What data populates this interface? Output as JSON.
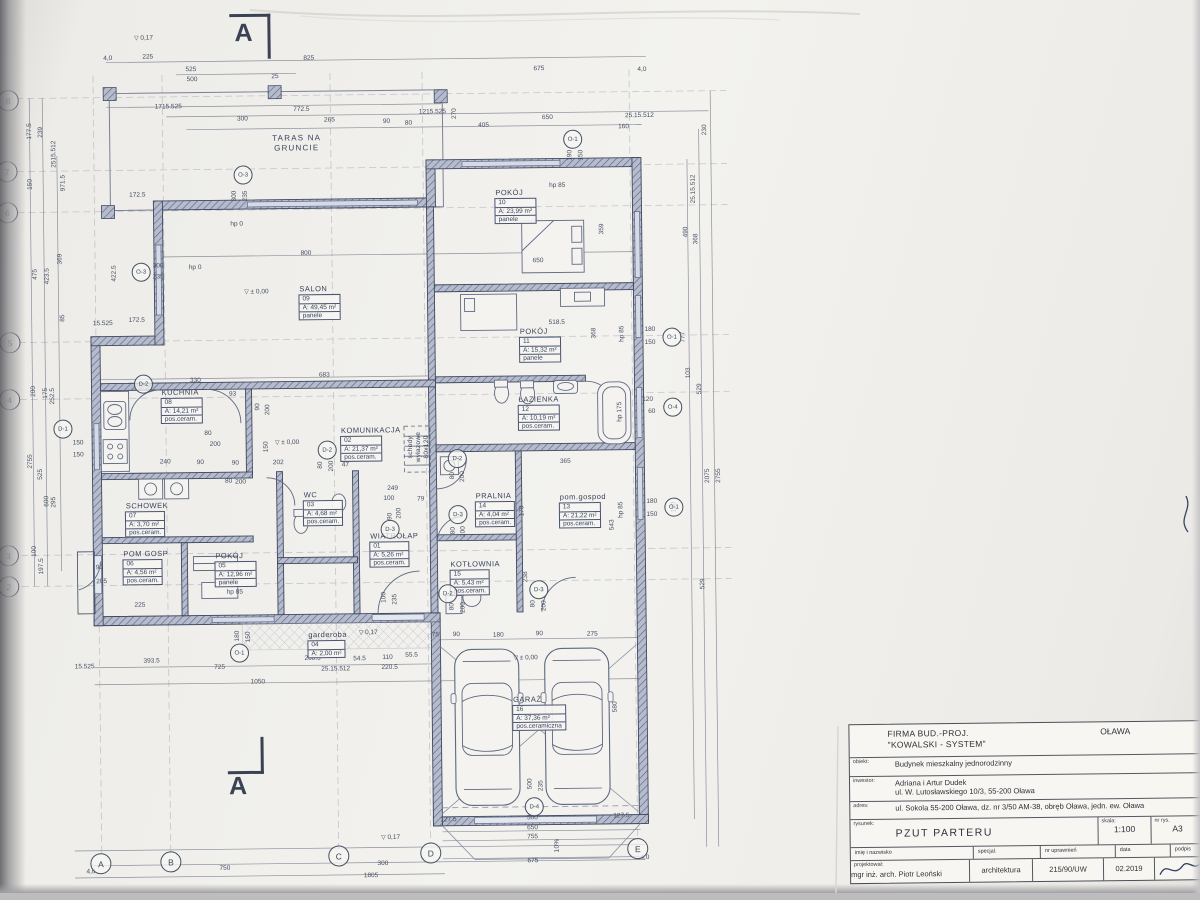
{
  "section": {
    "label": "A"
  },
  "colors": {
    "ink": "#3d4659",
    "wall": "#3e4860",
    "paper": "#f3f2ee",
    "accent": "#5d6880"
  },
  "titleblock": {
    "company1": "FIRMA BUD.-PROJ.",
    "company2": "\"KOWALSKI - SYSTEM\"",
    "city": "OŁAWA",
    "city_addr": "ul.Brzeska 19",
    "obiekt_label": "obiekt:",
    "obiekt": "Budynek mieszkalny jednorodzinny",
    "inwestor_label": "inwestor:",
    "inwestor1": "Adriana i Artur Dudek",
    "inwestor2": "ul. W. Lutosławskiego 10/3, 55-200 Oława",
    "adres_label": "adres:",
    "adres": "ul. Sokola 55-200 Oława, dz. nr 3/50 AM-38, obręb Oława, jedn. ew. Oława",
    "rysunek_label": "rysunek:",
    "rysunek": "PZUT PARTERU",
    "skala_label": "skala:",
    "skala": "1:100",
    "nr_label": "nr rys.",
    "nr": "A3",
    "h_name": "imię i nazwisko",
    "h_spec": "specjal.",
    "h_lic": "nr uprawnień",
    "h_date": "data",
    "h_sign": "podpis",
    "proj_label": "projektował:",
    "proj_name": "mgr inż. arch. Piotr Leoński",
    "proj_spec": "architektura",
    "proj_lic": "215/90/UW",
    "proj_date": "02.2019"
  },
  "plan": {
    "rooms": [
      {
        "id": "wiatrolap",
        "name": "WIATROŁAP",
        "num": "01",
        "area": "A: 5,26 m²",
        "fin": "pos.ceram.",
        "x": 368,
        "y": 530
      },
      {
        "id": "komunikacja",
        "name": "KOMUNIKACJA",
        "num": "02",
        "area": "A: 21,37 m²",
        "fin": "pos.ceram.",
        "x": 340,
        "y": 424
      },
      {
        "id": "wc",
        "name": "WC",
        "num": "03",
        "area": "A: 4,68 m²",
        "fin": "pos.ceram.",
        "x": 302,
        "y": 488
      },
      {
        "id": "garderoba",
        "name": "garderoba",
        "num": "04",
        "area": "A: 2,00 m²",
        "fin": "",
        "x": 305,
        "y": 628
      },
      {
        "id": "pokoj-05",
        "name": "POKÓJ",
        "num": "05",
        "area": "A: 12,96 m²",
        "fin": "panele",
        "x": 213,
        "y": 548
      },
      {
        "id": "pom-gosp",
        "name": "POM GOSP",
        "num": "06",
        "area": "A: 4,56 m²",
        "fin": "pos.ceram.",
        "x": 121,
        "y": 545
      },
      {
        "id": "schowek",
        "name": "SCHOWEK",
        "num": "07",
        "area": "A: 3,70 m²",
        "fin": "pos.ceram.",
        "x": 124,
        "y": 497
      },
      {
        "id": "kuchnia",
        "name": "KUCHNIA",
        "num": "08",
        "area": "A: 14,21 m²",
        "fin": "pos.ceram.",
        "x": 161,
        "y": 384
      },
      {
        "id": "salon",
        "name": "SALON",
        "num": "09",
        "area": "A: 49,45 m²",
        "fin": "panele",
        "x": 300,
        "y": 282
      },
      {
        "id": "pokoj-10",
        "name": "POKÓJ",
        "num": "10",
        "area": "A: 23,99 m²",
        "fin": "panele",
        "x": 497,
        "y": 188
      },
      {
        "id": "pokoj-11",
        "name": "POKÓJ",
        "num": "11",
        "area": "A: 15,32 m²",
        "fin": "panele",
        "x": 520,
        "y": 327
      },
      {
        "id": "lazienka",
        "name": "ŁAZIENKA",
        "num": "12",
        "area": "A: 10,19 m²",
        "fin": "pos.ceram.",
        "x": 518,
        "y": 395
      },
      {
        "id": "pom-gospod",
        "name": "pom.gospod",
        "num": "13",
        "area": "A: 21,22 m²",
        "fin": "pos.ceram.",
        "x": 558,
        "y": 493
      },
      {
        "id": "pralnia",
        "name": "PRALNIA",
        "num": "14",
        "area": "A: 4,04 m²",
        "fin": "pos.ceram.",
        "x": 474,
        "y": 491
      },
      {
        "id": "kotlownia",
        "name": "KOTŁOWNIA",
        "num": "15",
        "area": "A: 5,43 m²",
        "fin": "pos.ceram.",
        "x": 448,
        "y": 559
      },
      {
        "id": "garaz",
        "name": "GARAŻ",
        "num": "16",
        "area": "A: 37,36 m²",
        "fin": "pos.ceramiczna",
        "x": 509,
        "y": 695
      }
    ],
    "dims": [
      [
        "4,0",
        112,
        53
      ],
      [
        "225",
        152,
        52
      ],
      [
        "825",
        313,
        55
      ],
      [
        "675",
        543,
        68
      ],
      [
        "4,0",
        646,
        70
      ],
      [
        "525",
        195,
        65
      ],
      [
        "500",
        196,
        75
      ],
      [
        "25",
        279,
        73
      ],
      [
        "1715.525",
        172,
        102
      ],
      [
        "772.5",
        305,
        106
      ],
      [
        "300",
        246,
        115
      ],
      [
        "265",
        333,
        117
      ],
      [
        "90",
        390,
        119
      ],
      [
        "80",
        412,
        121
      ],
      [
        "1215.525",
        436,
        110
      ],
      [
        "270",
        458,
        112,
        1
      ],
      [
        "405",
        487,
        124
      ],
      [
        "650",
        551,
        117
      ],
      [
        "160",
        627,
        127
      ],
      [
        "25.15.512",
        643,
        116
      ],
      [
        "190",
        573,
        155,
        1
      ],
      [
        "150",
        584,
        155,
        1
      ],
      [
        "230",
        708,
        131,
        1
      ],
      [
        "25.15.512",
        696,
        190,
        1
      ],
      [
        "490",
        688,
        233,
        1
      ],
      [
        "368",
        698,
        240,
        1
      ],
      [
        "777",
        684,
        338,
        1
      ],
      [
        "103",
        689,
        374,
        1
      ],
      [
        "529",
        700,
        390,
        1
      ],
      [
        "2075",
        707,
        477,
        1
      ],
      [
        "2755",
        718,
        477,
        1
      ],
      [
        "180",
        651,
        330
      ],
      [
        "150",
        651,
        343
      ],
      [
        "120",
        648,
        400
      ],
      [
        "60",
        652,
        412
      ],
      [
        "180",
        651,
        502
      ],
      [
        "150",
        651,
        515
      ],
      [
        "190",
        673,
        508,
        1
      ],
      [
        "543",
        611,
        525,
        1
      ],
      [
        "529",
        701,
        585,
        1
      ],
      [
        "580",
        612,
        707,
        1
      ],
      [
        "177.5",
        33,
        125,
        1
      ],
      [
        "239",
        44,
        126,
        1
      ],
      [
        "2515.512",
        57,
        148,
        1
      ],
      [
        "150",
        33,
        178,
        1
      ],
      [
        "971.5",
        66,
        177,
        1
      ],
      [
        "369",
        62,
        253,
        1
      ],
      [
        "475",
        37,
        268,
        1
      ],
      [
        "423.5",
        49,
        270,
        1
      ],
      [
        "85",
        64,
        312,
        1
      ],
      [
        "200",
        34,
        385,
        1
      ],
      [
        "175",
        46,
        387,
        1
      ],
      [
        "252.5",
        53,
        390,
        1
      ],
      [
        "2755",
        30,
        455,
        1
      ],
      [
        "525",
        40,
        468,
        1
      ],
      [
        "600",
        46,
        495,
        1
      ],
      [
        "295",
        53,
        496,
        1
      ],
      [
        "100",
        33,
        545,
        1
      ],
      [
        "197.5",
        40,
        560,
        1
      ],
      [
        "172.5",
        140,
        190
      ],
      [
        "172.5",
        138,
        315
      ],
      [
        "422.5",
        116,
        268,
        1
      ],
      [
        "15.525",
        104,
        318
      ],
      [
        "15.525",
        82,
        661
      ],
      [
        "750",
        220,
        864
      ],
      [
        "300",
        378,
        861
      ],
      [
        "1805",
        366,
        873
      ],
      [
        "4,0",
        86,
        866
      ],
      [
        "393.5",
        149,
        656
      ],
      [
        "725",
        217,
        663
      ],
      [
        "1050",
        255,
        678
      ],
      [
        "268.5",
        310,
        655
      ],
      [
        "54.5",
        357,
        656
      ],
      [
        "110",
        385,
        655
      ],
      [
        "55.5",
        409,
        653
      ],
      [
        "220.5",
        387,
        665
      ],
      [
        "25.15.512",
        333,
        666
      ],
      [
        "500",
        528,
        817
      ],
      [
        "650",
        528,
        827
      ],
      [
        "755",
        528,
        836
      ],
      [
        "675",
        528,
        860
      ],
      [
        "127.5",
        444,
        818
      ],
      [
        "127.5",
        617,
        816
      ],
      [
        "4,0",
        640,
        858
      ],
      [
        "75",
        433,
        633
      ],
      [
        "90",
        454,
        633
      ],
      [
        "180",
        496,
        634
      ],
      [
        "90",
        537,
        633
      ],
      [
        "275",
        590,
        634
      ],
      [
        "500",
        526,
        783,
        1
      ],
      [
        "235",
        537,
        785,
        1
      ],
      [
        "100",
        382,
        595,
        1
      ],
      [
        "235",
        393,
        597,
        1
      ],
      [
        "180",
        235,
        632,
        1
      ],
      [
        "150",
        246,
        633,
        1
      ],
      [
        "800",
        308,
        250
      ],
      [
        "683",
        325,
        372
      ],
      [
        "650",
        540,
        260
      ],
      [
        "518.5",
        558,
        322
      ],
      [
        "359",
        604,
        229,
        1
      ],
      [
        "368",
        595,
        333,
        1
      ],
      [
        "330",
        196,
        376
      ],
      [
        "93",
        233,
        390
      ],
      [
        "90",
        258,
        403,
        1
      ],
      [
        "200",
        268,
        406,
        1
      ],
      [
        "150",
        78,
        437
      ],
      [
        "150",
        78,
        449
      ],
      [
        "240",
        165,
        457
      ],
      [
        "90",
        200,
        458
      ],
      [
        "90",
        235,
        459
      ],
      [
        "80",
        208,
        429
      ],
      [
        "200",
        215,
        440
      ],
      [
        "80",
        228,
        477
      ],
      [
        "200",
        240,
        478
      ],
      [
        "249",
        392,
        486
      ],
      [
        "100",
        388,
        496
      ],
      [
        "79",
        420,
        497
      ],
      [
        "90",
        389,
        514,
        1
      ],
      [
        "200",
        398,
        511,
        1
      ],
      [
        "47",
        345,
        462
      ],
      [
        "202",
        278,
        459
      ],
      [
        "150",
        266,
        443,
        1
      ],
      [
        "365",
        565,
        461
      ],
      [
        "170",
        521,
        510,
        1
      ],
      [
        "238",
        524,
        576,
        1
      ],
      [
        "80",
        452,
        474,
        1
      ],
      [
        "200",
        462,
        475,
        1
      ],
      [
        "80",
        452,
        529,
        1
      ],
      [
        "200",
        462,
        530,
        1
      ],
      [
        "80",
        450,
        605,
        1
      ],
      [
        "200",
        461,
        606,
        1
      ],
      [
        "80",
        531,
        603,
        1
      ],
      [
        "200",
        542,
        605,
        1
      ],
      [
        "80",
        320,
        462,
        1
      ],
      [
        "200",
        331,
        463,
        1
      ],
      [
        "90",
        98,
        562
      ],
      [
        "205",
        100,
        576
      ],
      [
        "225",
        138,
        600
      ],
      [
        "300",
        237,
        192,
        1
      ],
      [
        "235",
        248,
        192,
        1
      ],
      [
        "300",
        160,
        261
      ],
      [
        "235",
        160,
        272
      ],
      [
        "hp 0",
        239,
        220
      ],
      [
        "hp 0",
        197,
        263
      ],
      [
        "hp 85",
        560,
        185
      ],
      [
        "hp 85",
        233,
        588
      ],
      [
        "hp 85",
        623,
        334,
        1
      ],
      [
        "hp 175",
        620,
        412,
        1
      ],
      [
        "hp 85",
        620,
        510,
        1
      ]
    ],
    "levels": [
      [
        "± 0,00",
        258,
        288
      ],
      [
        "± 0,00",
        287,
        439
      ],
      [
        "± 0,00",
        523,
        657
      ],
      [
        "0,17",
        148,
        33
      ],
      [
        "0,17",
        366,
        630
      ],
      [
        "0,17",
        386,
        835
      ]
    ],
    "notes": [
      [
        "TARAS NA\nGRUNCIE",
        300,
        140,
        0
      ],
      [
        "schody\nwyłazowe\n80x120",
        419,
        445,
        1
      ],
      [
        "10%",
        553,
        845,
        1
      ]
    ],
    "markers": [
      [
        "O-3",
        143,
        267
      ],
      [
        "O-3",
        246,
        171
      ],
      [
        "O-1",
        576,
        139
      ],
      [
        "O-1",
        673,
        338
      ],
      [
        "O-4",
        673,
        408
      ],
      [
        "O-1",
        673,
        508
      ],
      [
        "O-1",
        237,
        649
      ],
      [
        "D-1",
        63,
        423
      ],
      [
        "D-2",
        144,
        379
      ],
      [
        "D-2",
        327,
        447
      ],
      [
        "D-2",
        457,
        457
      ],
      [
        "D-2",
        446,
        592
      ],
      [
        "D-3",
        457,
        513
      ],
      [
        "D-3",
        389,
        527
      ],
      [
        "D-3",
        537,
        589
      ],
      [
        "D-4",
        530,
        806
      ]
    ],
    "grid_rows": [
      [
        "8",
        12,
        94
      ],
      [
        "7",
        10,
        165
      ],
      [
        "6",
        10,
        206
      ],
      [
        "5",
        11,
        336
      ],
      [
        "4",
        10,
        393
      ],
      [
        "3",
        7,
        549
      ],
      [
        "2",
        7,
        580
      ]
    ],
    "grid_cols": [
      [
        "A",
        96,
        858
      ],
      [
        "B",
        166,
        857
      ],
      [
        "C",
        334,
        853
      ],
      [
        "D",
        426,
        851
      ],
      [
        "E",
        633,
        849
      ]
    ]
  }
}
